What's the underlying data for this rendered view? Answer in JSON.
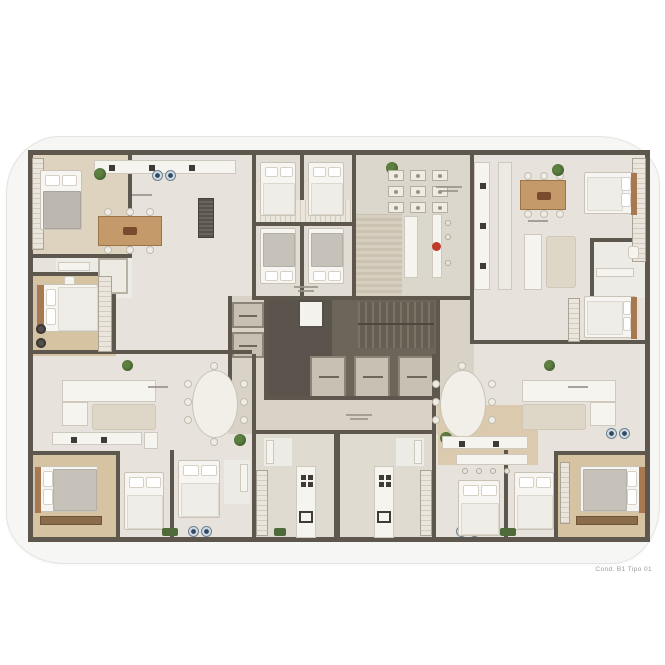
{
  "document": {
    "caption": "Cond. B1 Tipo 01"
  },
  "plan": {
    "kind": "residential-floor-plan",
    "core": {
      "elevator_count": 5,
      "has_stairs": true
    },
    "colors": {
      "background": "#ffffff",
      "card_bg": "#f6f7f5",
      "wall": "#5e574d",
      "floor": "#e7e3dc",
      "hall_floor": "#d9d3c7",
      "wood_floor": "#d6c3a2",
      "core_floor": "#6b655a",
      "plant": "#4a6b35"
    }
  }
}
